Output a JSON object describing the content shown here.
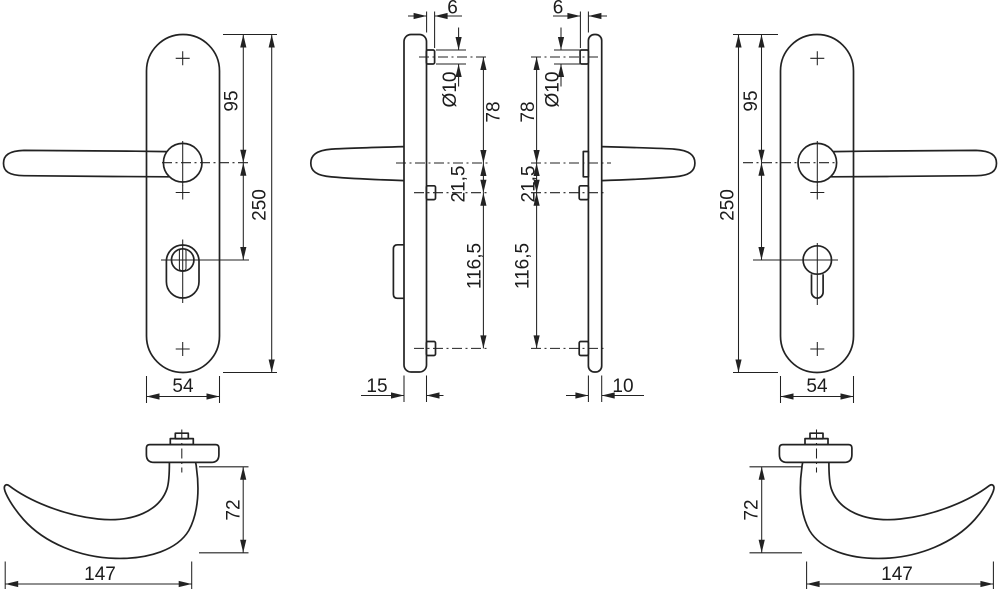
{
  "drawing": {
    "background": "#ffffff",
    "line_color": "#222222",
    "views": {
      "front_exterior": {
        "dims": {
          "top_to_handle": "95",
          "total_height": "250",
          "width": "54"
        }
      },
      "side_exterior": {
        "dims": {
          "pin_protrusion": "6",
          "pin_diameter": "Ø10",
          "pin_to_handle": "78",
          "handle_to_lower_pin": "21,5",
          "lower_to_bottom_pin": "116,5",
          "thickness": "15"
        }
      },
      "side_interior": {
        "dims": {
          "pin_protrusion": "6",
          "pin_diameter": "Ø10",
          "pin_to_handle": "78",
          "handle_to_lower_pin": "21,5",
          "lower_to_bottom_pin": "116,5",
          "thickness": "10"
        }
      },
      "front_interior": {
        "dims": {
          "top_to_handle": "95",
          "total_height": "250",
          "width": "54"
        }
      },
      "lever_left": {
        "dims": {
          "height": "72",
          "length": "147"
        }
      },
      "lever_right": {
        "dims": {
          "height": "72",
          "length": "147"
        }
      }
    }
  }
}
